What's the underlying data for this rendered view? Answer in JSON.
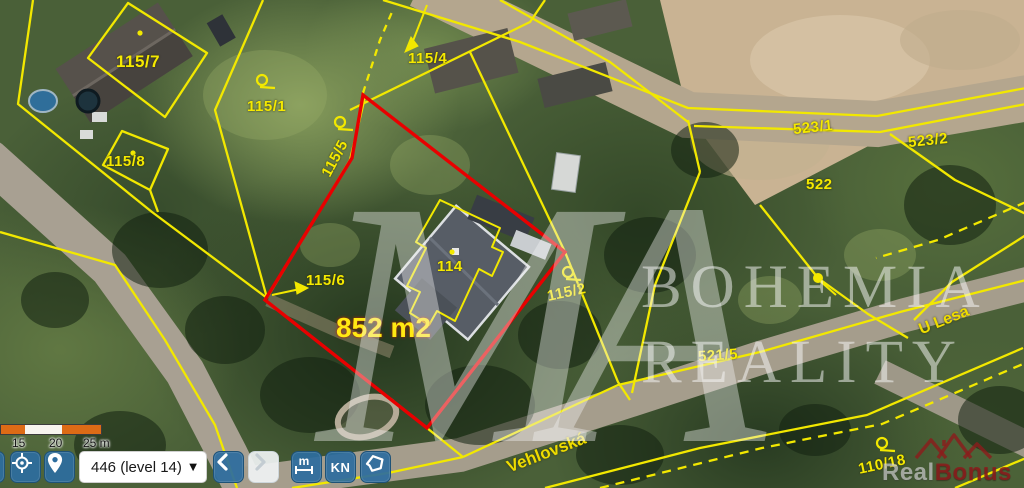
{
  "map": {
    "highlight": {
      "area_label": "852 m2",
      "outline_color": "#e80000"
    },
    "parcel_labels": [
      {
        "text": "115/7"
      },
      {
        "text": "115/1"
      },
      {
        "text": "115/8"
      },
      {
        "text": "115/4"
      },
      {
        "text": "115/5"
      },
      {
        "text": "115/6"
      },
      {
        "text": "114"
      },
      {
        "text": "115/2"
      },
      {
        "text": "523/1"
      },
      {
        "text": "523/2"
      },
      {
        "text": "522"
      },
      {
        "text": "521/5"
      },
      {
        "text": "110/18"
      }
    ],
    "street_labels": [
      {
        "text": "Vehlovská"
      },
      {
        "text": "U Lesa"
      }
    ],
    "line_color": "#f2e800",
    "symbols": [
      "boundary-circle-marker",
      "boundary-dot-marker",
      "leader-arrow"
    ]
  },
  "watermark": {
    "monogram": "MA",
    "title_line1": "BOHEMIA",
    "title_line2": "REALITY"
  },
  "brand_logo": {
    "icon": "roofs-icon",
    "text_primary": "Real",
    "text_secondary": "Bonus"
  },
  "toolbar": {
    "scale_bar": {
      "tick_labels": [
        "15",
        "20",
        "25 m"
      ],
      "bar_orange": "#dd6b16"
    },
    "level_select": {
      "value": "446 (level 14)",
      "caret_icon": "▼"
    },
    "buttons": [
      {
        "name": "locate",
        "icon": "crosshair-icon"
      },
      {
        "name": "marker",
        "icon": "location-pin-icon"
      },
      {
        "name": "back",
        "icon": "chevron-left-icon"
      },
      {
        "name": "forward",
        "icon": "chevron-right-icon",
        "disabled": true
      },
      {
        "name": "measure",
        "icon": "measure-icon",
        "label": "m"
      },
      {
        "name": "kn",
        "label": "KN"
      },
      {
        "name": "draw-area",
        "icon": "polygon-icon"
      }
    ],
    "button_blue": "#2d6d9e"
  }
}
